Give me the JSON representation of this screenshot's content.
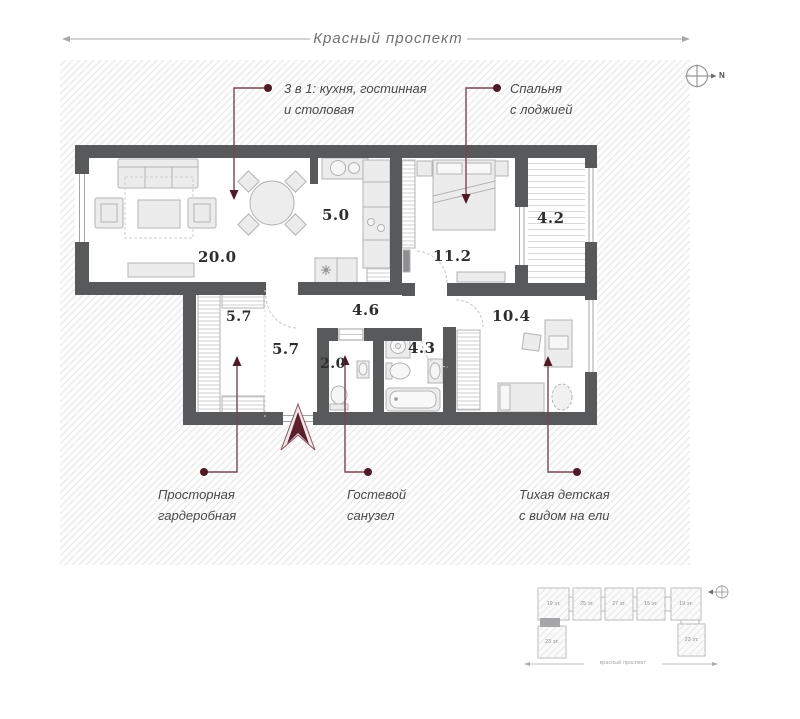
{
  "header": {
    "street_label": "Красный проспект"
  },
  "compass": {
    "letter": "N"
  },
  "callouts": {
    "kitchen_living": {
      "line1": "3 в 1: кухня, гостинная",
      "line2": "и столовая"
    },
    "bedroom": {
      "line1": "Спальня",
      "line2": "с лоджией"
    },
    "wardrobe": {
      "line1": "Просторная",
      "line2": "гардеробная"
    },
    "guest_wc": {
      "line1": "Гостевой",
      "line2": "санузел"
    },
    "children": {
      "line1": "Тихая детская",
      "line2": "с видом на ели"
    }
  },
  "rooms": {
    "living": {
      "area": "20.0"
    },
    "kitchen": {
      "area": "5.0"
    },
    "bedroom": {
      "area": "11.2"
    },
    "loggia": {
      "area": "4.2"
    },
    "wardrobe": {
      "area": "5.7"
    },
    "hall": {
      "area": "5.7"
    },
    "corridor": {
      "area": "4.6"
    },
    "guest_wc": {
      "area": "2.0"
    },
    "bathroom": {
      "area": "4.3"
    },
    "children": {
      "area": "10.4"
    }
  },
  "minimap": {
    "top_blocks": [
      "19 эт.",
      "25 эт.",
      "27 эт.",
      "15 эт.",
      "19 эт."
    ],
    "left_block": "23 эт.",
    "right_block": "23 эт.",
    "street_label": "красный проспект"
  },
  "colors": {
    "accent": "#5e1f2c",
    "wall": "#58595b"
  }
}
